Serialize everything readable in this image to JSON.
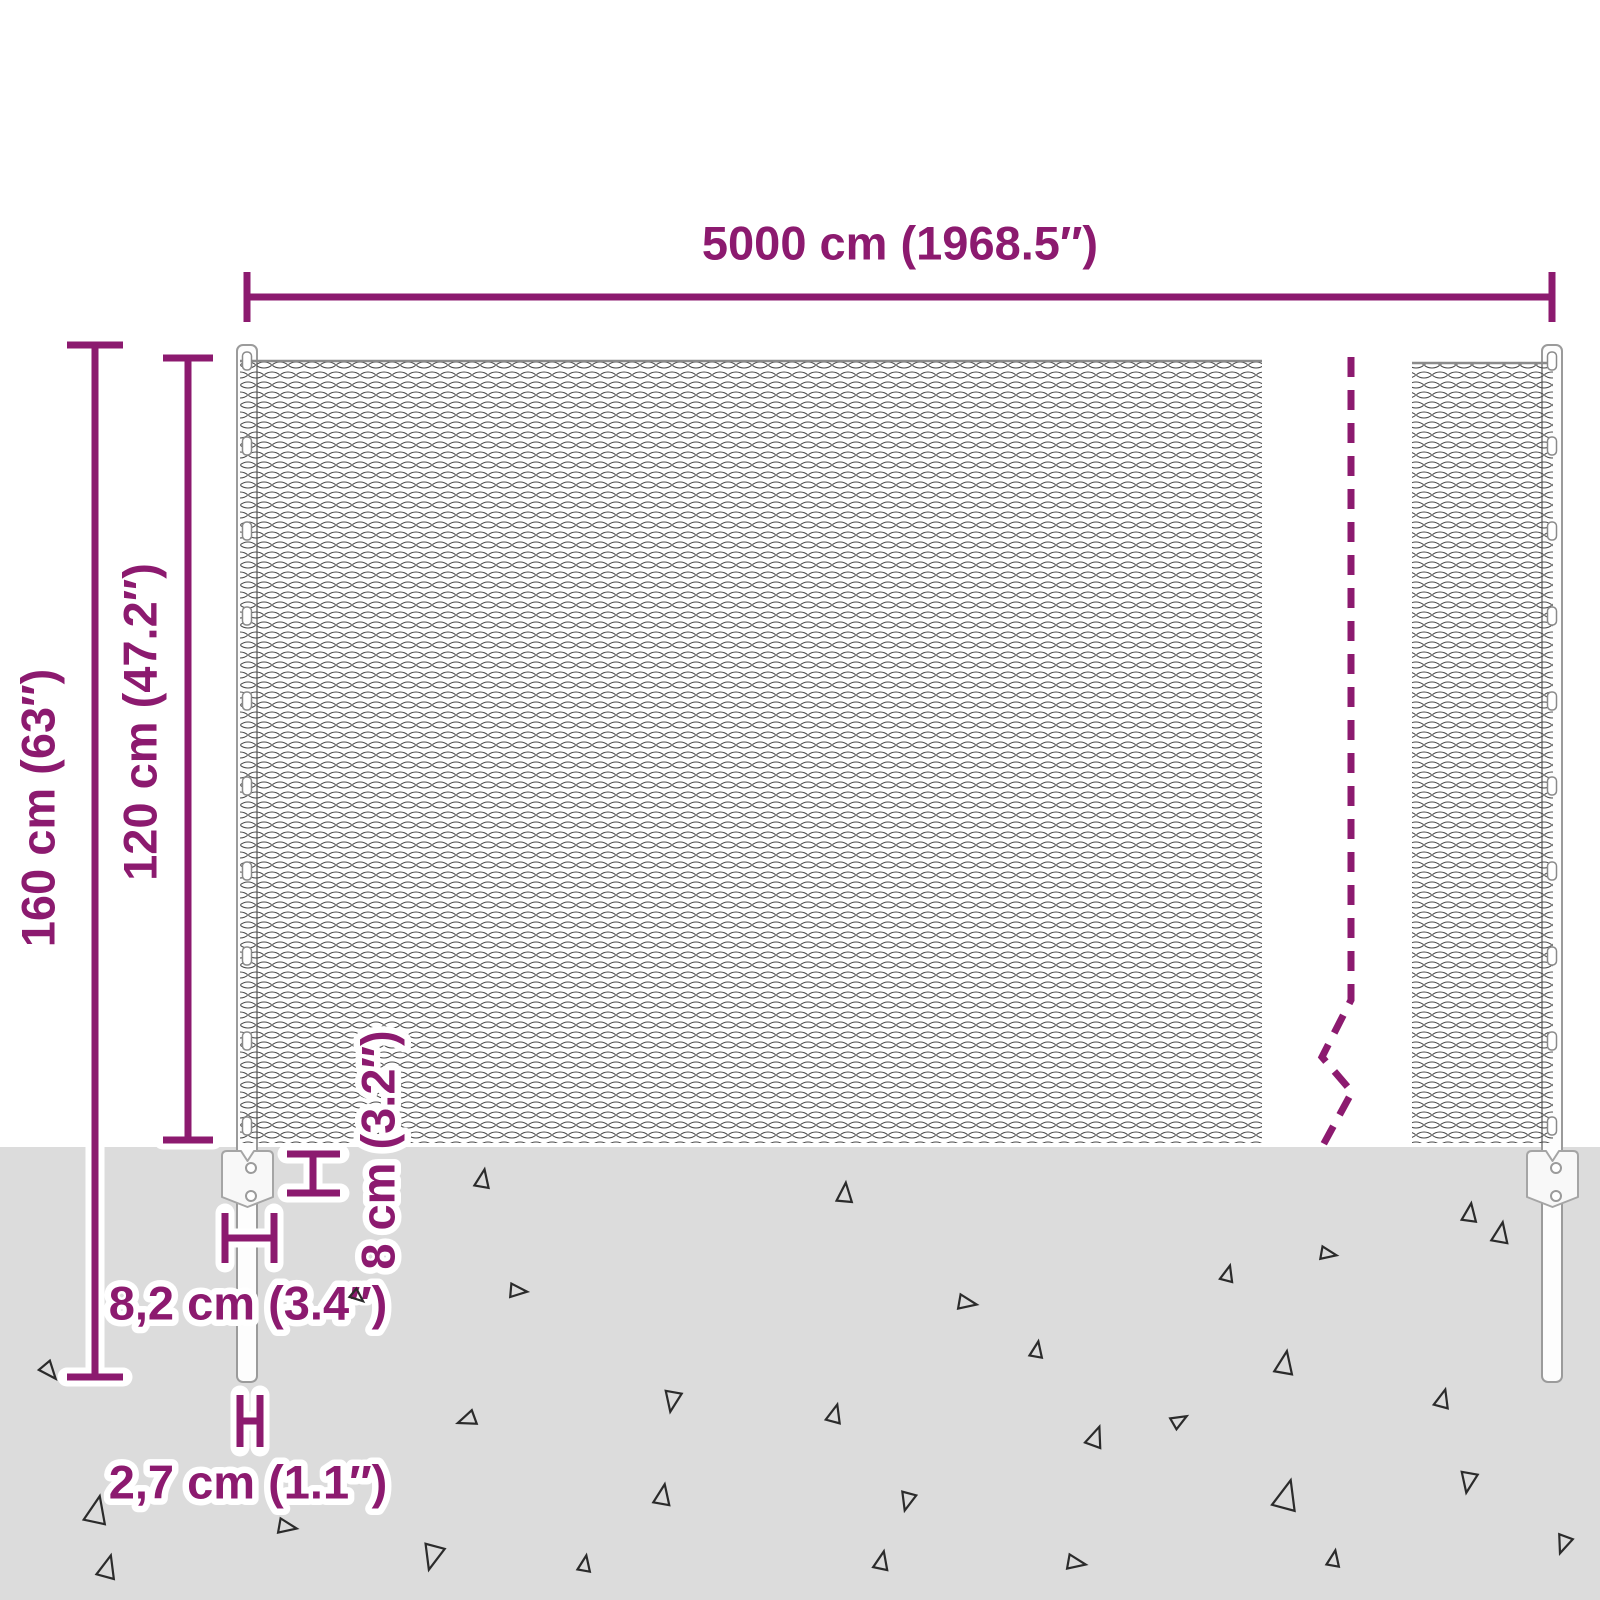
{
  "colors": {
    "accent": "#8c1a6f",
    "ground": "#dcdcdc",
    "mesh_line": "#4a4a4a",
    "mesh_link": "#8a8a8a",
    "hardware_outline": "#9b9b9b"
  },
  "labels": {
    "fence_width": "5000 cm (1968.5″)",
    "post_total_height": "160 cm (63″)",
    "fence_height": "120 cm (47.2″)",
    "anchor_depth": "8 cm (3.2″)",
    "anchor_width": "8,2 cm (3.4″)",
    "post_diameter": "2,7 cm (1.1″)"
  },
  "decor": {
    "post_centers": [
      247,
      1552
    ],
    "clip_ys": [
      352,
      437,
      522,
      607,
      692,
      777,
      862,
      947,
      1032,
      1117
    ],
    "triangles": [
      {
        "x": 50,
        "y": 1372,
        "s": 0.8,
        "r": 140
      },
      {
        "x": 483,
        "y": 1178,
        "s": 0.8,
        "r": 10
      },
      {
        "x": 845,
        "y": 1192,
        "s": 0.85,
        "r": 5
      },
      {
        "x": 1470,
        "y": 1212,
        "s": 0.8,
        "r": 8
      },
      {
        "x": 1501,
        "y": 1232,
        "s": 0.9,
        "r": 10
      },
      {
        "x": 1329,
        "y": 1254,
        "s": 0.7,
        "r": 100
      },
      {
        "x": 519,
        "y": 1291,
        "s": 0.75,
        "r": 95
      },
      {
        "x": 968,
        "y": 1303,
        "s": 0.8,
        "r": 100
      },
      {
        "x": 1228,
        "y": 1273,
        "s": 0.7,
        "r": 15
      },
      {
        "x": 358,
        "y": 1297,
        "s": 0.6,
        "r": 130
      },
      {
        "x": 1037,
        "y": 1349,
        "s": 0.7,
        "r": 10
      },
      {
        "x": 1285,
        "y": 1362,
        "s": 1.0,
        "r": 10
      },
      {
        "x": 466,
        "y": 1420,
        "s": 0.8,
        "r": 250
      },
      {
        "x": 672,
        "y": 1402,
        "s": 0.9,
        "r": 190
      },
      {
        "x": 835,
        "y": 1413,
        "s": 0.8,
        "r": 15
      },
      {
        "x": 1096,
        "y": 1436,
        "s": 0.9,
        "r": 20
      },
      {
        "x": 1443,
        "y": 1398,
        "s": 0.8,
        "r": 15
      },
      {
        "x": 1180,
        "y": 1420,
        "s": 0.7,
        "r": 60
      },
      {
        "x": 97,
        "y": 1509,
        "s": 1.2,
        "r": 12
      },
      {
        "x": 288,
        "y": 1527,
        "s": 0.8,
        "r": 100
      },
      {
        "x": 663,
        "y": 1494,
        "s": 0.9,
        "r": 10
      },
      {
        "x": 907,
        "y": 1502,
        "s": 0.8,
        "r": 195
      },
      {
        "x": 1287,
        "y": 1494,
        "s": 1.3,
        "r": 15
      },
      {
        "x": 1468,
        "y": 1483,
        "s": 0.9,
        "r": 190
      },
      {
        "x": 432,
        "y": 1558,
        "s": 1.1,
        "r": 195
      },
      {
        "x": 585,
        "y": 1563,
        "s": 0.7,
        "r": 10
      },
      {
        "x": 882,
        "y": 1560,
        "s": 0.8,
        "r": 12
      },
      {
        "x": 1077,
        "y": 1563,
        "s": 0.8,
        "r": 100
      },
      {
        "x": 1334,
        "y": 1558,
        "s": 0.7,
        "r": 10
      },
      {
        "x": 108,
        "y": 1566,
        "s": 1.0,
        "r": 15
      },
      {
        "x": 1563,
        "y": 1545,
        "s": 0.8,
        "r": 200
      }
    ]
  }
}
